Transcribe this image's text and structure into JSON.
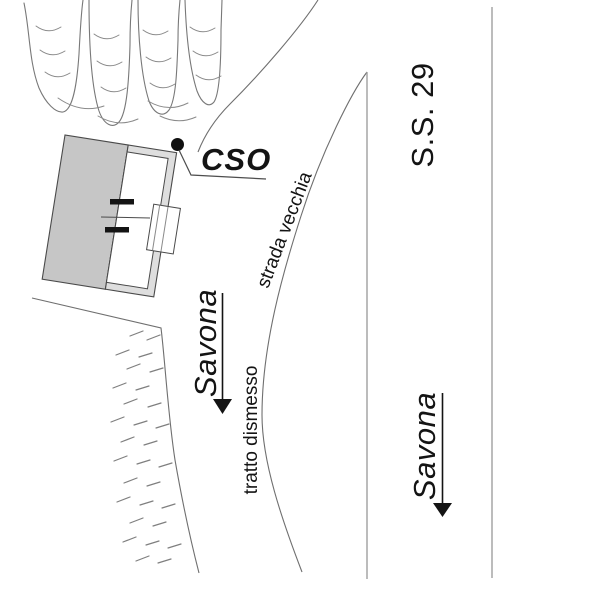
{
  "map": {
    "site_label": "CSO",
    "roads": {
      "highway_name": "S.S. 29",
      "old_road_name": "strada vecchia",
      "disused_section_name": "tratto dismesso"
    },
    "directions": {
      "old_road_destination": "Savona",
      "highway_destination": "Savona"
    },
    "colors": {
      "background": "#ffffff",
      "ink": "#141414",
      "thin_line": "#6f6f6f",
      "road_line": "#a0a0a0",
      "building_fill": "#c6c6c6",
      "wall_band_fill": "#dedede",
      "marker_dot": "#111111",
      "hatch": "#7f7f7f"
    }
  }
}
